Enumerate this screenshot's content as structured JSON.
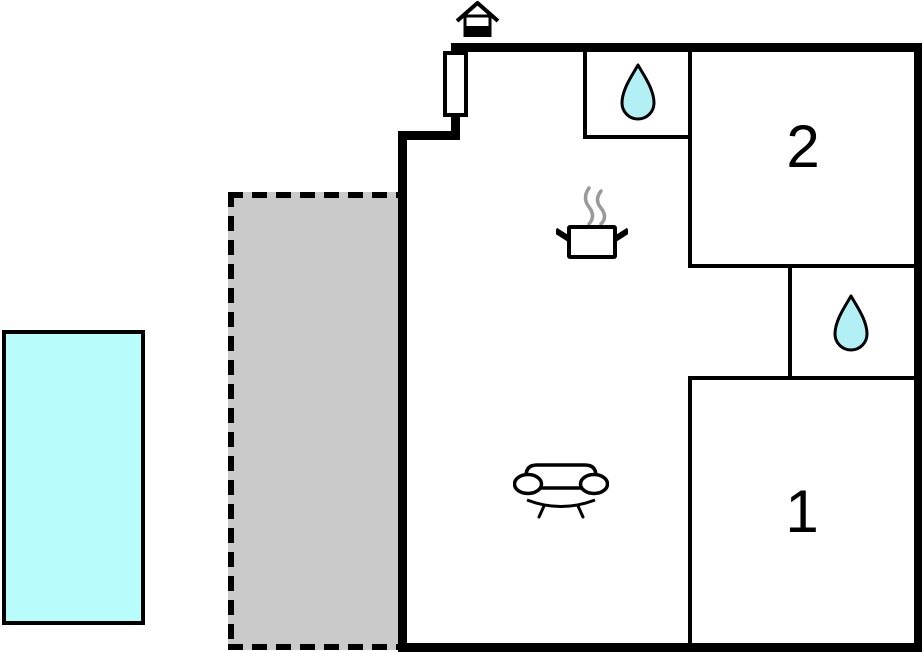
{
  "colors": {
    "background": "#ffffff",
    "wall": "#000000",
    "pool": "#b9fcfc",
    "terrace": "#cacaca",
    "drop": "#b3f0f6",
    "steam": "#9a9a9a"
  },
  "rooms": [
    {
      "id": "room-2",
      "label": "2"
    },
    {
      "id": "room-1",
      "label": "1"
    }
  ],
  "icons": [
    "entrance-icon",
    "water-drop-icon-bathroom-top",
    "water-drop-icon-bathroom-middle",
    "cooking-pot-icon",
    "sofa-icon"
  ]
}
